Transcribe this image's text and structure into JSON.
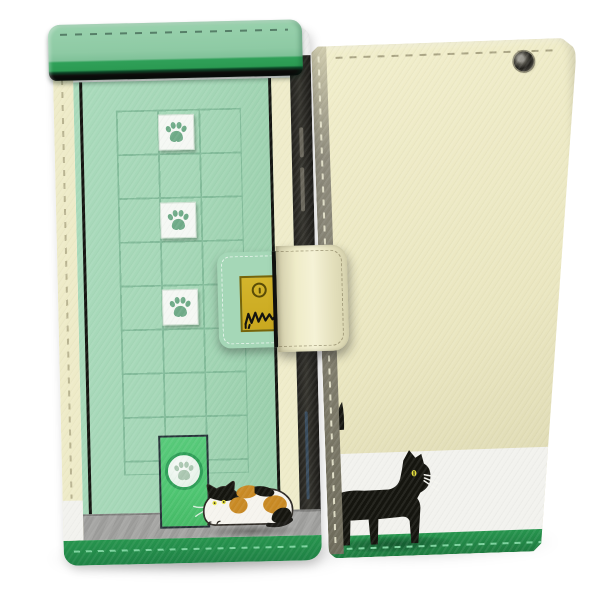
{
  "product": {
    "type": "smartphone flip wallet case, cat design",
    "views_shown": [
      "front closed",
      "back"
    ],
    "background": "plain white studio backdrop with soft floor shadows"
  },
  "front_case": {
    "label": "Flip case front: mint-green cat-door building design",
    "flap_label": "Green top flap with stitching",
    "grid": {
      "columns": 3,
      "rows": 8
    },
    "paw_tile_count": 3,
    "elements": [
      "top flap",
      "window grid",
      "white paw-print tiles",
      "green cat-flap door with paw circle",
      "calico cat sitting by door",
      "gray ground strip",
      "green bottom edge",
      "cream spine with stitches",
      "dark phone edge with side buttons"
    ]
  },
  "clasp": {
    "label": "Clasp strap: printed lock plate with keyhole and cat scratch marks",
    "elements": [
      "mint printed section",
      "gold lock plate",
      "keyhole",
      "black claw scratches",
      "cream leather band with stitching"
    ]
  },
  "back_case": {
    "label": "Case back: cream leather with walking black cat",
    "elements": [
      "camera eyelet",
      "top stitching",
      "black cat with yellow eye and white whiskers",
      "raised tail tip behind spine",
      "white band",
      "green grass band",
      "olive spine with stitches"
    ]
  },
  "colors": {
    "bg": "#ffffff",
    "mint": "#a5d7b7",
    "mint_deep": "#97cda9",
    "grid_line": "#7db795",
    "flap_green": "#8ecaa4",
    "flap_lip": "#2fa058",
    "flap_lip_dark": "#0d4527",
    "door_green": "#4fc672",
    "door_border": "#263238",
    "door_ring": "#2f9f58",
    "case_green": "#27954e",
    "case_green_dark": "#1e7b40",
    "stitch_light_green": "#7cd39e",
    "cream": "#eeebc8",
    "cream_edge": "#efecca",
    "back_cream": "#eae6c0",
    "back_cream_light": "#f1eecb",
    "back_cream_dark": "#d9d5ae",
    "band_white": "#f2f2ee",
    "ground_gray": "#9c9c9a",
    "ground_gray_dark": "#7e7e7c",
    "spine_olive": "#8e8b7c",
    "phone_dark": "#35342e",
    "phone_light": "#6a675c",
    "plate_yellow": "#c9a81f",
    "plate_yellow_light": "#d4b52c",
    "plate_border": "#77650a",
    "keyhole": "#5a4c07",
    "paw_green": "#6fab88",
    "paw_pale": "#abc7b1",
    "tile_white": "#f5f8f4",
    "cat_black": "#15150f",
    "cat_outline": "#2e2a24",
    "cat_orange": "#c98a24",
    "cat_white": "#f6f4ee",
    "eye_yellow": "#e6e03c",
    "stitch_dark": "#567f68",
    "stitch_cream": "#b9b491",
    "stitch_olive": "#aaa584",
    "blue_streak": "#3e5a78"
  }
}
